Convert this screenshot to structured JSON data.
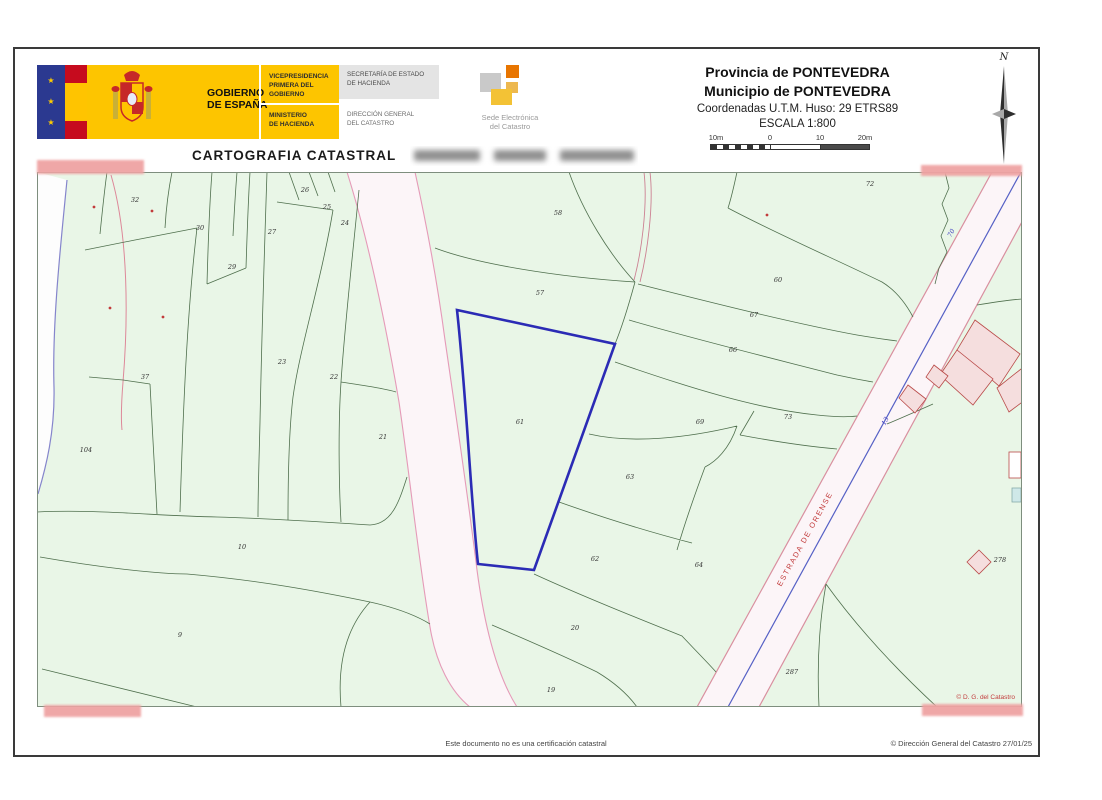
{
  "header": {
    "logo": {
      "star": "★",
      "gobierno1": "GOBIERNO",
      "gobierno2": "DE ESPAÑA",
      "vice1": "VICEPRESIDENCIA",
      "vice2": "PRIMERA DEL GOBIERNO",
      "min1": "MINISTERIO",
      "min2": "DE HACIENDA",
      "sec1": "SECRETARÍA DE ESTADO",
      "sec2": "DE HACIENDA",
      "dir1": "DIRECCIÓN GENERAL",
      "dir2": "DEL CATASTRO",
      "sede1": "Sede Electrónica",
      "sede2": "del Catastro"
    },
    "province": "Provincia de PONTEVEDRA",
    "municipality": "Municipio de PONTEVEDRA",
    "coordinates": "Coordenadas U.T.M. Huso: 29 ETRS89",
    "scale": "ESCALA 1:800",
    "scale_labels": [
      "10m",
      "0",
      "10",
      "20m"
    ],
    "north_label": "N"
  },
  "title": "CARTOGRAFIA CATASTRAL",
  "map": {
    "road_label": "ESTRADA DE ORENSE",
    "road_number_70": "70",
    "road_number_13": "13",
    "copyright": "© D. G. del Catastro",
    "highlighted_parcel": "61",
    "parcels": [
      {
        "n": "32",
        "x": 98,
        "y": 30
      },
      {
        "n": "30",
        "x": 163,
        "y": 58
      },
      {
        "n": "27",
        "x": 235,
        "y": 62
      },
      {
        "n": "26",
        "x": 268,
        "y": 20
      },
      {
        "n": "25",
        "x": 290,
        "y": 37
      },
      {
        "n": "24",
        "x": 308,
        "y": 53
      },
      {
        "n": "29",
        "x": 195,
        "y": 97
      },
      {
        "n": "23",
        "x": 245,
        "y": 192
      },
      {
        "n": "22",
        "x": 297,
        "y": 207
      },
      {
        "n": "37",
        "x": 108,
        "y": 207
      },
      {
        "n": "104",
        "x": 49,
        "y": 280
      },
      {
        "n": "21",
        "x": 346,
        "y": 267
      },
      {
        "n": "10",
        "x": 205,
        "y": 377
      },
      {
        "n": "9",
        "x": 143,
        "y": 465
      },
      {
        "n": "58",
        "x": 521,
        "y": 43
      },
      {
        "n": "57",
        "x": 503,
        "y": 123
      },
      {
        "n": "61",
        "x": 483,
        "y": 252
      },
      {
        "n": "63",
        "x": 593,
        "y": 307
      },
      {
        "n": "62",
        "x": 558,
        "y": 389
      },
      {
        "n": "64",
        "x": 662,
        "y": 395
      },
      {
        "n": "20",
        "x": 538,
        "y": 458
      },
      {
        "n": "19",
        "x": 514,
        "y": 520
      },
      {
        "n": "72",
        "x": 833,
        "y": 14
      },
      {
        "n": "60",
        "x": 741,
        "y": 110
      },
      {
        "n": "67",
        "x": 717,
        "y": 145
      },
      {
        "n": "66",
        "x": 696,
        "y": 180
      },
      {
        "n": "69",
        "x": 663,
        "y": 252
      },
      {
        "n": "73",
        "x": 751,
        "y": 247
      },
      {
        "n": "287",
        "x": 755,
        "y": 502
      },
      {
        "n": "278",
        "x": 963,
        "y": 390
      }
    ],
    "red_marks": [
      {
        "x": 57,
        "y": 35
      },
      {
        "x": 115,
        "y": 39
      },
      {
        "x": 73,
        "y": 136
      },
      {
        "x": 126,
        "y": 145
      },
      {
        "x": 730,
        "y": 43
      }
    ]
  },
  "footer": {
    "disclaimer": "Este documento no es una certificación catastral",
    "copyright": "© Dirección General del Catastro 27/01/25"
  },
  "colors": {
    "accent_yellow": "#fdc500",
    "eu_blue": "#2b3990",
    "flag_red": "#c60b1e",
    "map_green": "#e9f6e7",
    "parcel_line": "#4f6f4d",
    "selected_parcel_blue": "#2b2bb5",
    "road_edge_pink": "#e59ab8",
    "road_center_blue": "#5560c5",
    "label_red": "#c23b3b",
    "redaction_pink": "#efa3a3"
  }
}
